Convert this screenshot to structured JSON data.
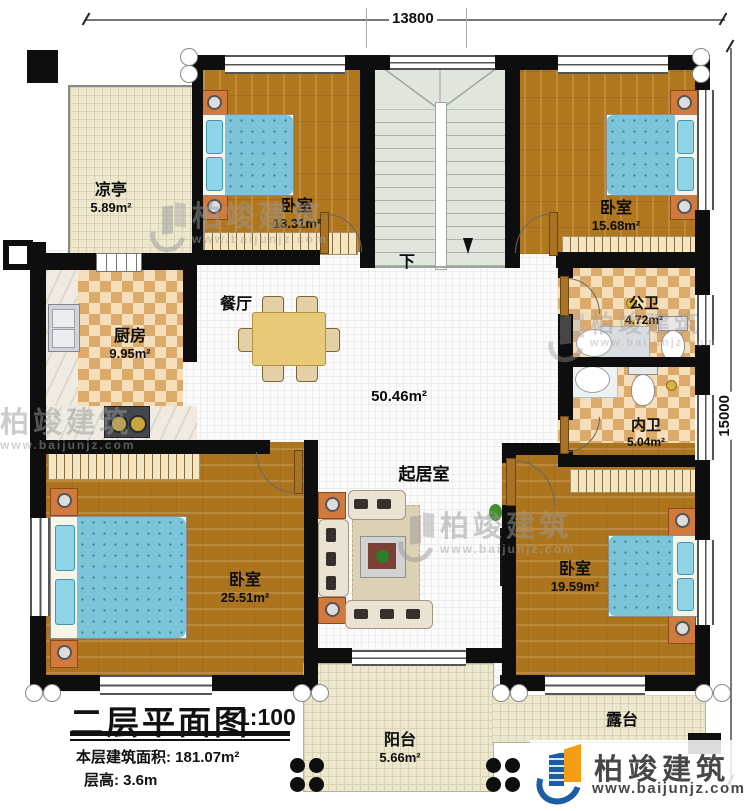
{
  "dimensions": {
    "top": "13800",
    "right": "15000"
  },
  "plan": {
    "pavilion": {
      "name": "凉亭",
      "area": "5.89m²"
    },
    "bedroom_top_left": {
      "name": "卧室",
      "area": "13.31m²"
    },
    "bedroom_top_right": {
      "name": "卧室",
      "area": "15.68m²"
    },
    "kitchen": {
      "name": "厨房",
      "area": "9.95m²"
    },
    "dining": {
      "name": "餐厅"
    },
    "living": {
      "name": "起居室",
      "area": "50.46m²"
    },
    "public_bath": {
      "name": "公卫",
      "area": "4.72m²"
    },
    "inner_bath": {
      "name": "内卫",
      "area": "5.04m²"
    },
    "bedroom_bottom_left": {
      "name": "卧室",
      "area": "25.51m²"
    },
    "bedroom_bottom_right": {
      "name": "卧室",
      "area": "19.59m²"
    },
    "balcony": {
      "name": "阳台",
      "area": "5.66m²"
    },
    "terrace": {
      "name": "露台"
    },
    "stairs": {
      "down": "下"
    }
  },
  "titleblock": {
    "title": "二层平面图",
    "scale": "1:100",
    "area_line": "本层建筑面积: 181.07m²",
    "height_line": "层高: 3.6m"
  },
  "brand": {
    "name": "柏竣建筑",
    "url": "www.baijunjz.com"
  },
  "watermark": {
    "name": "柏竣建筑",
    "url": "www.baijunjz.com"
  },
  "colors": {
    "accent_blue": "#1b5ea6",
    "accent_orange": "#f49d15",
    "wall": "#0e0e0e",
    "wood": "#b1771f",
    "bed_blue": "#7cc4d9"
  }
}
